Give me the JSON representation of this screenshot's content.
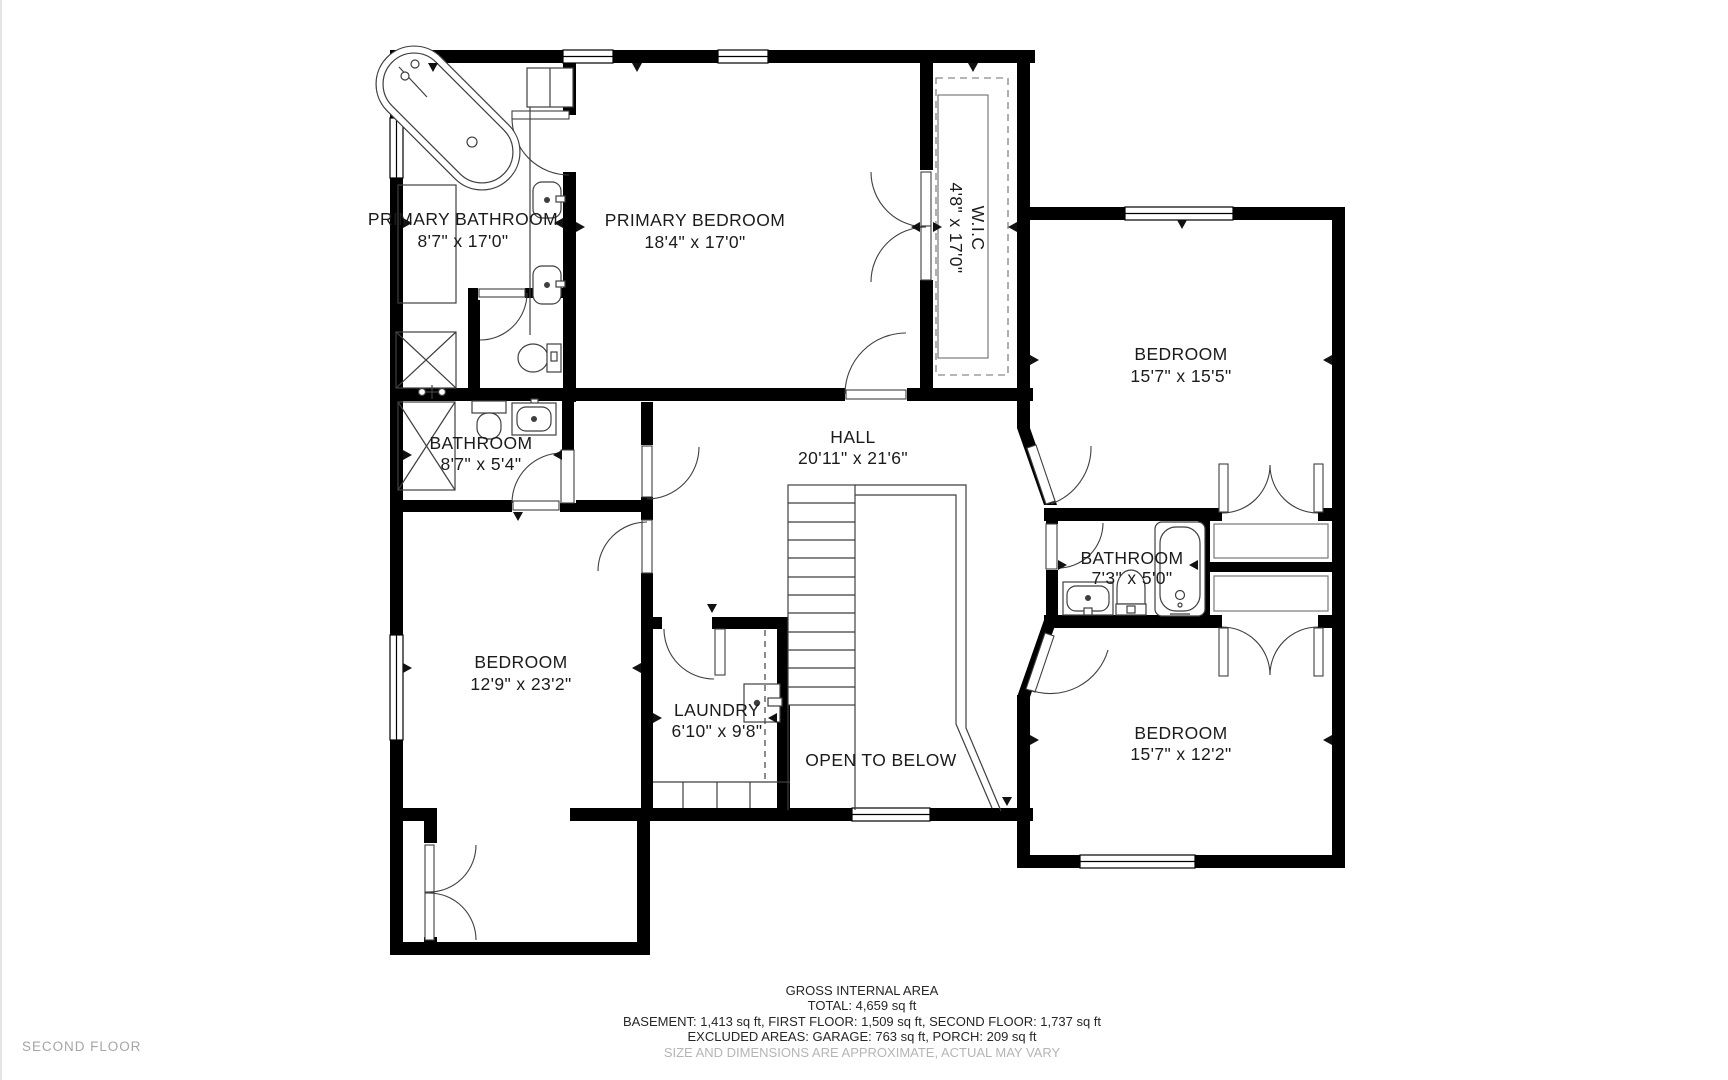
{
  "colors": {
    "background": "#ffffff",
    "wall": "#000000",
    "fixture_stroke": "#3f3f3f",
    "label": "#1b1b1b",
    "muted_text": "#a6a6a6",
    "disclaimer_text": "#b5b5b5"
  },
  "floor_label": "SECOND FLOOR",
  "rooms": [
    {
      "id": "primary-bathroom",
      "name": "PRIMARY BATHROOM",
      "dims": "8'7\" x 17'0\""
    },
    {
      "id": "primary-bedroom",
      "name": "PRIMARY BEDROOM",
      "dims": "18'4\" x 17'0\""
    },
    {
      "id": "walk-in-closet",
      "name": "W.I.C",
      "dims": "4'8\" x 17'0\""
    },
    {
      "id": "bedroom-top-right",
      "name": "BEDROOM",
      "dims": "15'7\" x 15'5\""
    },
    {
      "id": "bathroom-middle",
      "name": "BATHROOM",
      "dims": "8'7\" x 5'4\""
    },
    {
      "id": "hall",
      "name": "HALL",
      "dims": "20'11\" x 21'6\""
    },
    {
      "id": "bedroom-left",
      "name": "BEDROOM",
      "dims": "12'9\" x 23'2\""
    },
    {
      "id": "laundry",
      "name": "LAUNDRY",
      "dims": "6'10\" x 9'8\""
    },
    {
      "id": "open-to-below",
      "name": "OPEN TO BELOW",
      "dims": ""
    },
    {
      "id": "bathroom-right",
      "name": "BATHROOM",
      "dims": "7'3\" x 5'0\""
    },
    {
      "id": "bedroom-bottom-right",
      "name": "BEDROOM",
      "dims": "15'7\" x 12'2\""
    }
  ],
  "footer": {
    "title": "GROSS INTERNAL AREA",
    "total": "TOTAL: 4,659 sq ft",
    "breakdown": "BASEMENT: 1,413 sq ft, FIRST FLOOR: 1,509 sq ft, SECOND FLOOR: 1,737 sq ft",
    "excluded": "EXCLUDED AREAS: GARAGE: 763 sq ft, PORCH: 209 sq ft",
    "disclaimer": "SIZE AND DIMENSIONS ARE APPROXIMATE, ACTUAL MAY VARY"
  }
}
